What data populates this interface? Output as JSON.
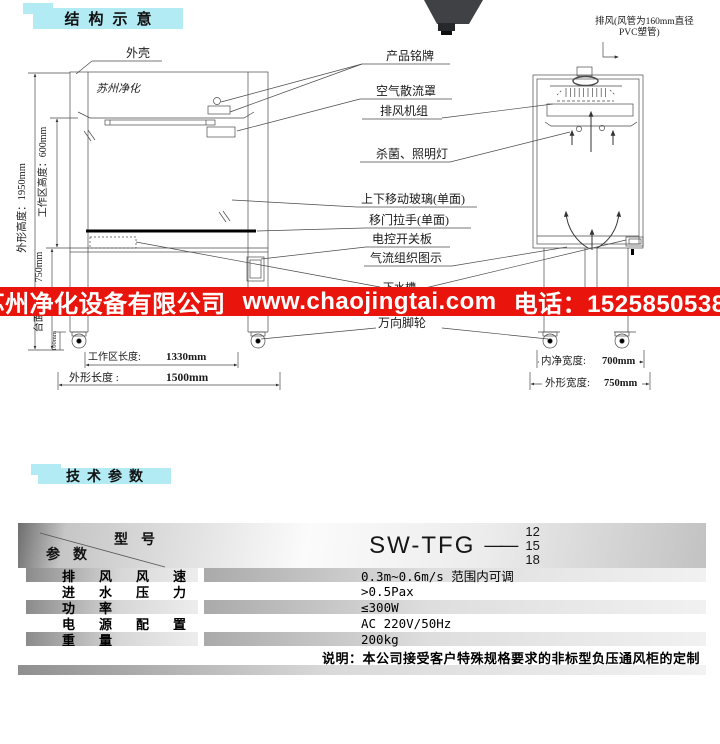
{
  "sections": {
    "structure_title": "结构示意",
    "specs_title": "技术参数"
  },
  "banner": {
    "company": "苏州净化设备有限公司",
    "website": "www.chaojingtai.com",
    "phone": "电话：15258505380"
  },
  "colors": {
    "badge_cyan": "#b2ebf3",
    "banner_red": "#e9150d",
    "banner_text": "#ffffff"
  },
  "diagram": {
    "brand_mark": "苏州净化",
    "part_labels": {
      "shell": "外壳",
      "nameplate": "产品铭牌",
      "exhaust_line1": "排风(风管为160mm直径",
      "exhaust_line2": "PVC塑管)",
      "diffuser": "空气散流罩",
      "exhaust_fan_unit": "排风机组",
      "uv_lamp": "杀菌、照明灯",
      "sliding_glass": "上下移动玻璃(单面)",
      "door_handle": "移门拉手(单面)",
      "switch_panel": "电控开关板",
      "airflow_diagram": "气流组织图示",
      "sink": "下水槽",
      "casters": "万向脚轮"
    },
    "dimensions": {
      "overall_height": "外形高度：1950mm",
      "work_area_height": "工作区高度：600mm",
      "worktop_height": "台面高度：750mm",
      "base_height": "100mm",
      "work_area_length_label": "工作区长度:",
      "work_area_length_value": "1330mm",
      "overall_length_label": "外形长度 :",
      "overall_length_value": "1500mm",
      "inner_width_label": "内净宽度:",
      "inner_width_value": "700mm",
      "overall_width_label": "外形宽度:",
      "overall_width_value": "750mm"
    }
  },
  "spec_table": {
    "model_header_label": "型号",
    "param_header_label": "参数",
    "model_value": "SW-TFG",
    "model_joiner": "——",
    "model_sizes": [
      "12",
      "15",
      "18"
    ],
    "rows": [
      {
        "name": "排风风速",
        "value": "0.3m~0.6m/s 范围内可调"
      },
      {
        "name": "进水压力",
        "value": ">0.5Pax"
      },
      {
        "name": "功率",
        "value": "≤300W"
      },
      {
        "name": "电源配置",
        "value": "AC 220V/50Hz"
      },
      {
        "name": "重量",
        "value": "200kg"
      }
    ],
    "note": "说明：本公司接受客户特殊规格要求的非标型负压通风柜的定制"
  }
}
